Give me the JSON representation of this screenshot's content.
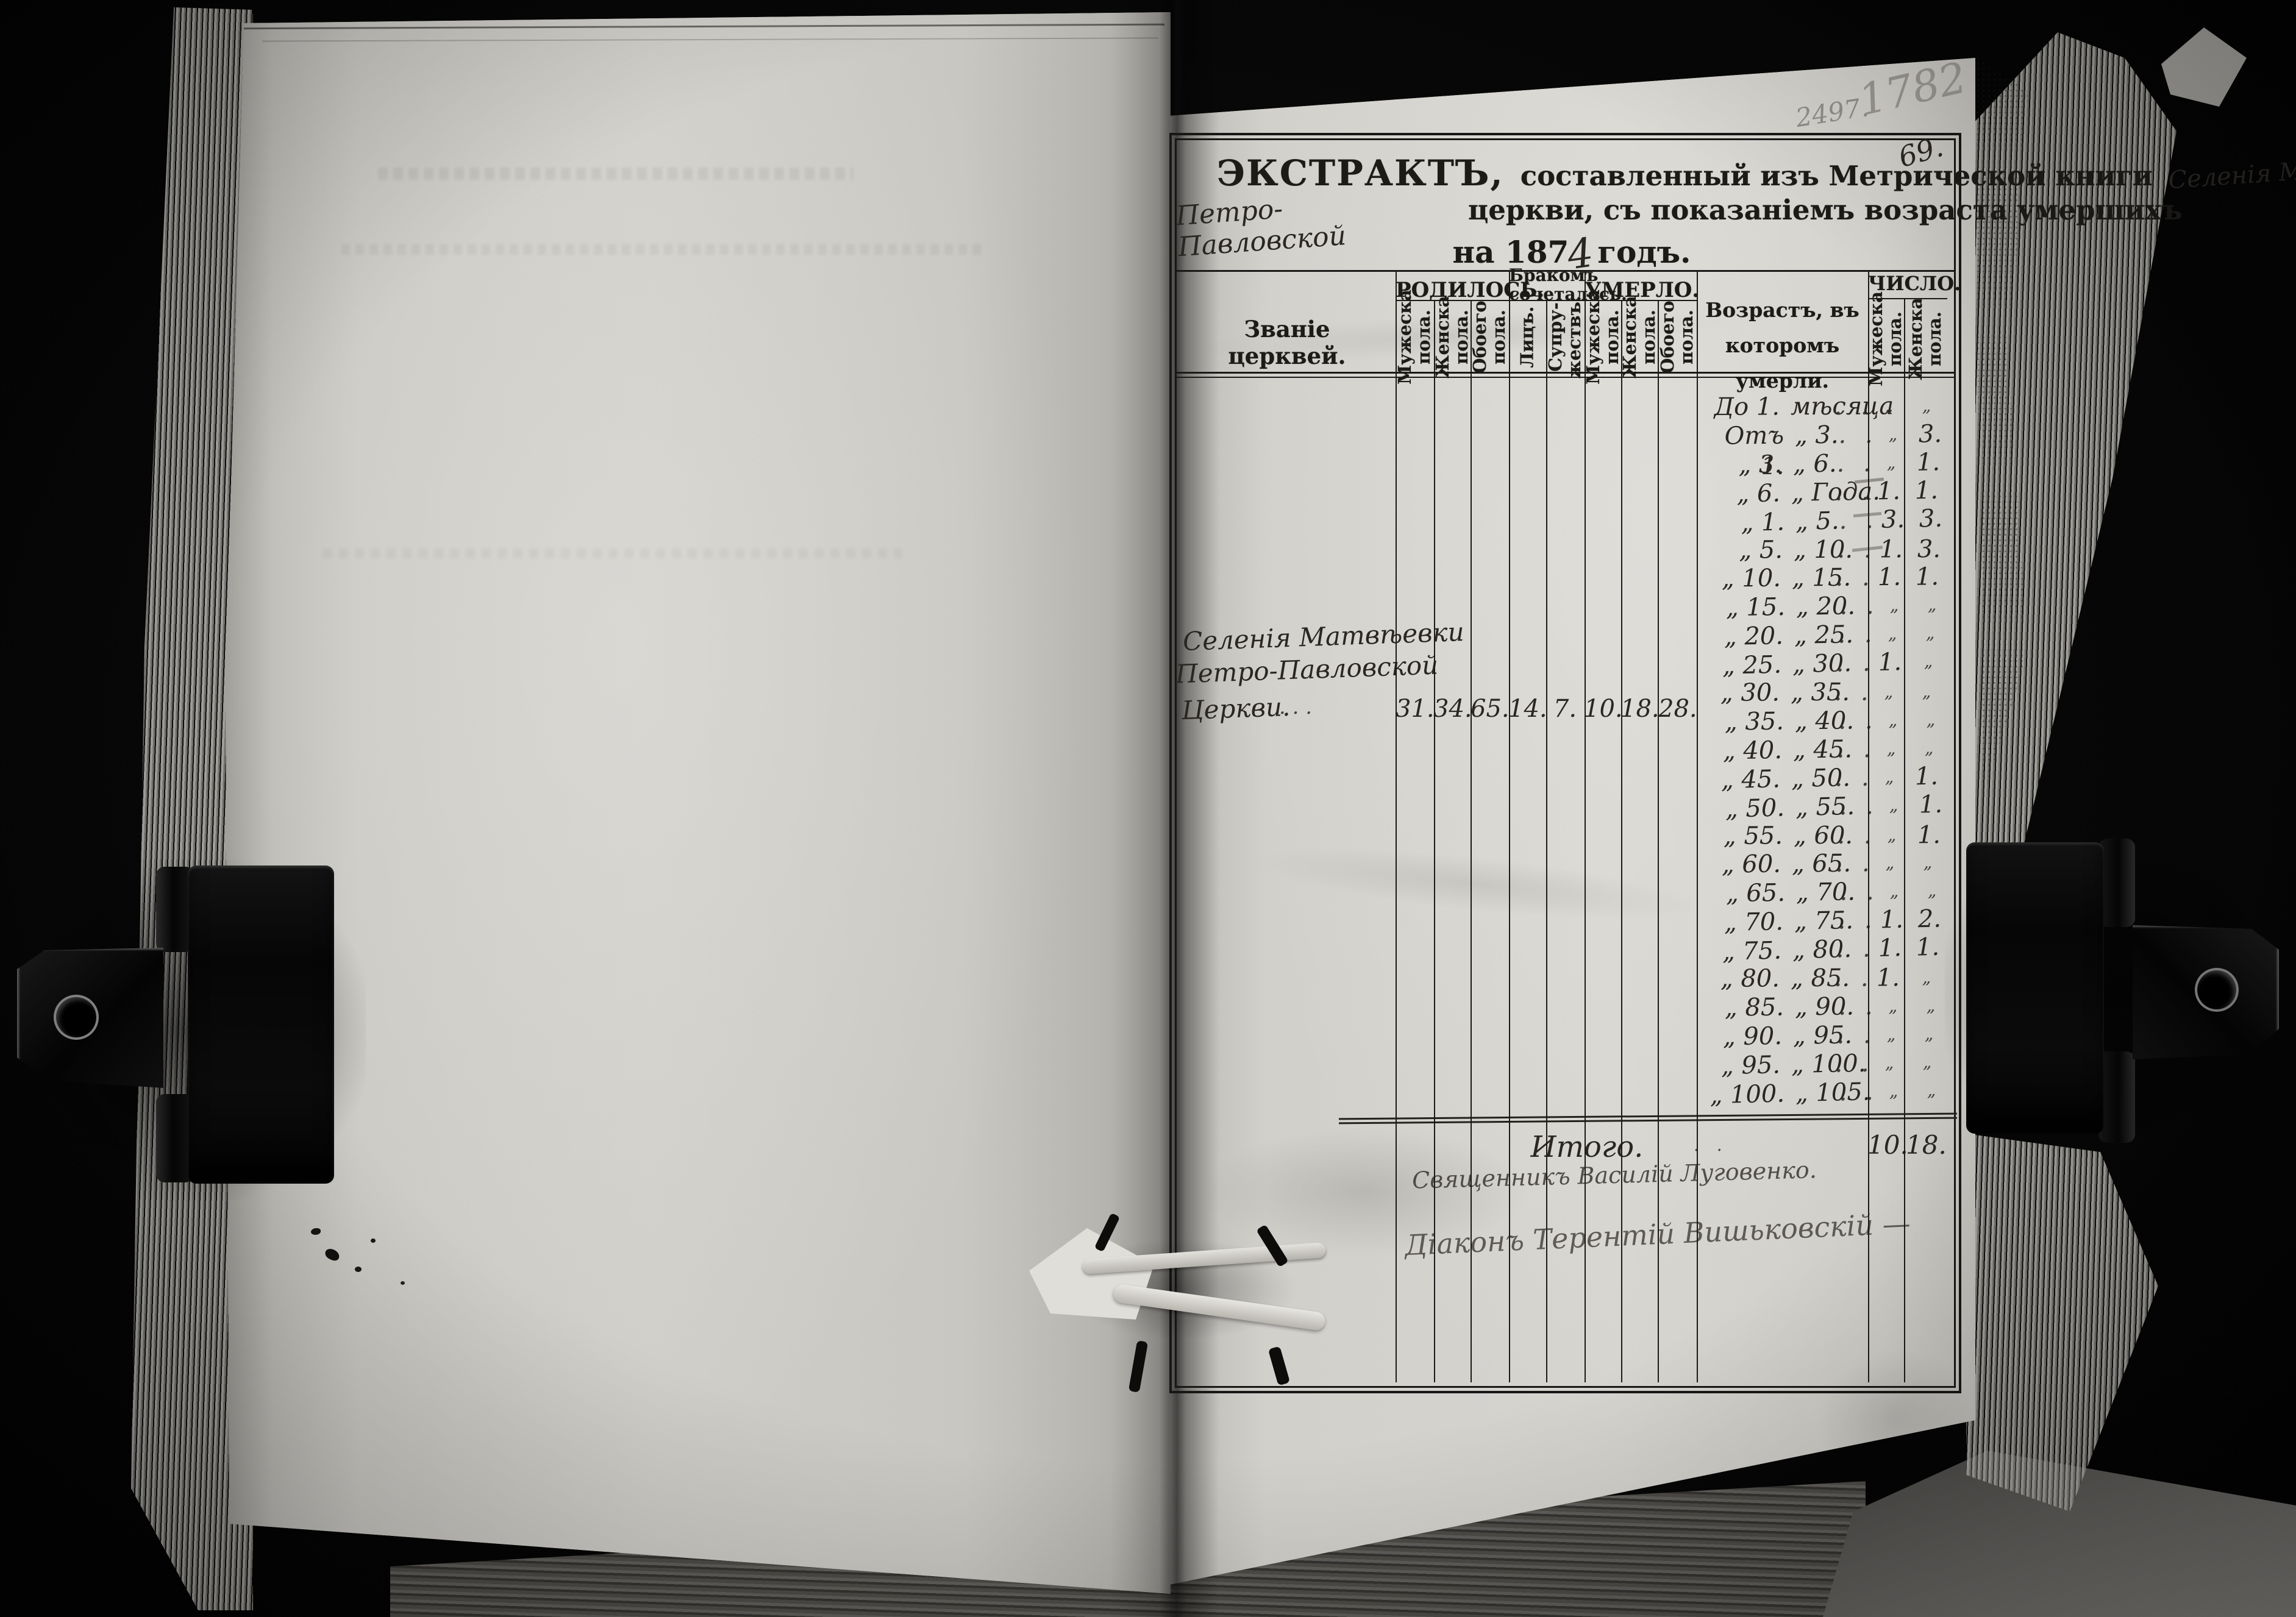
{
  "photo": {
    "pencil_number_small": "2497.",
    "pencil_number_large": "1782",
    "folio_number": "69."
  },
  "title": {
    "word_extract": "ЭКСТРАКТЪ,",
    "line1_printed": "составленный изъ Метрической книги",
    "line1_handwritten": "Селенія Матвѣевки",
    "line2_handwritten": "Петро-Павловской",
    "line2_printed": "церкви, съ показаніемъ возраста умершихъ",
    "line3_prefix": "на 187",
    "line3_year_digit": "4",
    "line3_suffix": "годъ."
  },
  "table": {
    "col_church": "Званіе церквей.",
    "group_born": "РОДИЛОСЬ.",
    "group_married": "Бракомъ\nсочеталось.",
    "group_died": "УМЕРЛО.",
    "col_age": "Возрастъ, въ которомъ\nумерли.",
    "group_number": "ЧИСЛО.",
    "sub_male": "Мужеска\nпола.",
    "sub_female": "Женска\nпола.",
    "sub_both": "Обоего\nпола.",
    "sub_persons": "Лицъ.",
    "sub_marriages": "Супру-\nжествъ.",
    "leader_dots": ". .",
    "church_entry": {
      "line1": "Селенія Матвѣевки",
      "line2": "Петро-Павловской",
      "line3": "Церкви.",
      "line3_dots": ".      .      .",
      "born_male": "31.",
      "born_female": "34.",
      "born_both": "65.",
      "married_persons": "14.",
      "married_couples": "7.",
      "died_male": "10.",
      "died_female": "18.",
      "died_both": "28."
    },
    "age_rows": [
      {
        "from": "До 1.",
        "to": "мѣсяца",
        "male": "„",
        "female": "„"
      },
      {
        "from": "Отъ 1.",
        "to": "„ 3.",
        "male": "„",
        "female": "3."
      },
      {
        "from": "„ 3.",
        "to": "„ 6.",
        "male": "„",
        "female": "1."
      },
      {
        "from": "„ 6.",
        "to": "„ Года.",
        "male": "1.",
        "female": "1."
      },
      {
        "from": "„ 1.",
        "to": "„ 5.",
        "male": "3.",
        "female": "3."
      },
      {
        "from": "„ 5.",
        "to": "„ 10.",
        "male": "1.",
        "female": "3."
      },
      {
        "from": "„ 10.",
        "to": "„ 15.",
        "male": "1.",
        "female": "1."
      },
      {
        "from": "„ 15.",
        "to": "„ 20.",
        "male": "„",
        "female": "„"
      },
      {
        "from": "„ 20.",
        "to": "„ 25.",
        "male": "„",
        "female": "„"
      },
      {
        "from": "„ 25.",
        "to": "„ 30.",
        "male": "1.",
        "female": "„"
      },
      {
        "from": "„ 30.",
        "to": "„ 35.",
        "male": "„",
        "female": "„"
      },
      {
        "from": "„ 35.",
        "to": "„ 40.",
        "male": "„",
        "female": "„"
      },
      {
        "from": "„ 40.",
        "to": "„ 45.",
        "male": "„",
        "female": "„"
      },
      {
        "from": "„ 45.",
        "to": "„ 50.",
        "male": "„",
        "female": "1."
      },
      {
        "from": "„ 50.",
        "to": "„ 55.",
        "male": "„",
        "female": "1."
      },
      {
        "from": "„ 55.",
        "to": "„ 60.",
        "male": "„",
        "female": "1."
      },
      {
        "from": "„ 60.",
        "to": "„ 65.",
        "male": "„",
        "female": "„"
      },
      {
        "from": "„ 65.",
        "to": "„ 70.",
        "male": "„",
        "female": "„"
      },
      {
        "from": "„ 70.",
        "to": "„ 75.",
        "male": "1.",
        "female": "2."
      },
      {
        "from": "„ 75.",
        "to": "„ 80.",
        "male": "1.",
        "female": "1."
      },
      {
        "from": "„ 80.",
        "to": "„ 85.",
        "male": "1.",
        "female": "„"
      },
      {
        "from": "„ 85.",
        "to": "„ 90.",
        "male": "„",
        "female": "„"
      },
      {
        "from": "„ 90.",
        "to": "„ 95.",
        "male": "„",
        "female": "„"
      },
      {
        "from": "„ 95.",
        "to": "„ 100.",
        "male": "„",
        "female": "„"
      },
      {
        "from": "„ 100.",
        "to": "„ 105.",
        "male": "„",
        "female": "„"
      }
    ],
    "total_row": {
      "label": "Итого.",
      "male": "10.",
      "female": "18."
    },
    "signatures": {
      "line1": "Священникъ Василій Луговенко.",
      "line2": "Діаконъ Терентій Вишьковскій —"
    }
  }
}
